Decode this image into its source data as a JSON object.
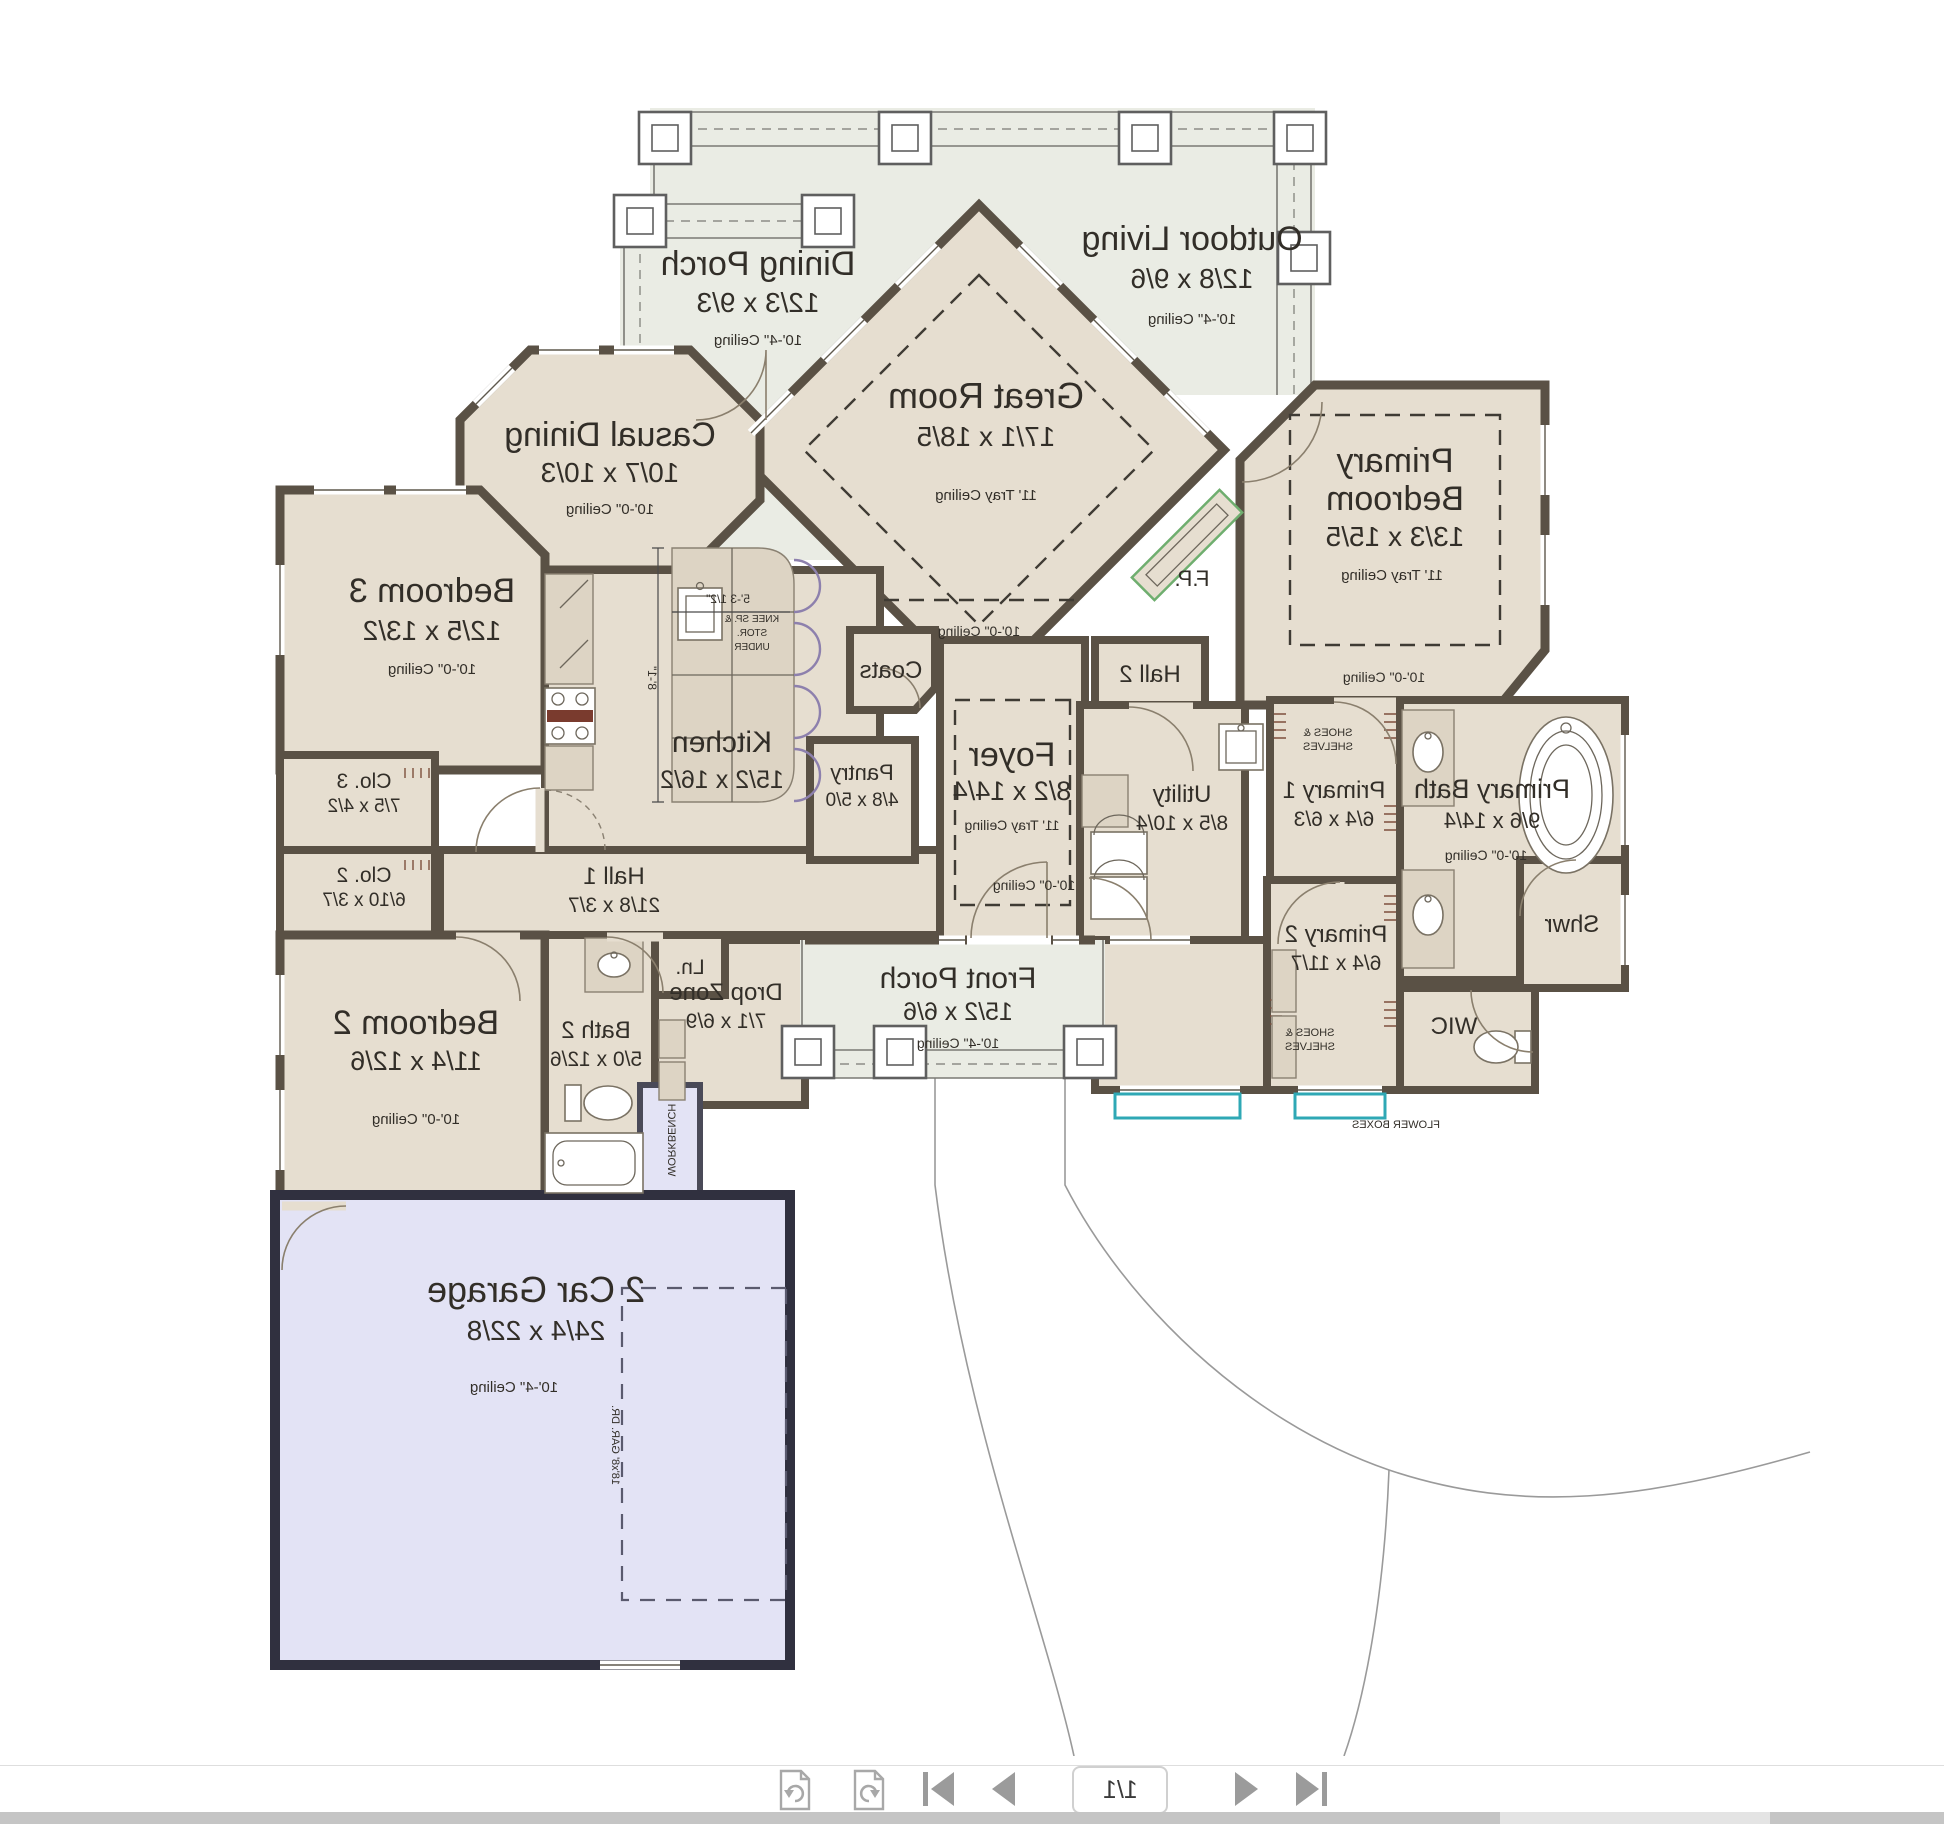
{
  "plan": {
    "rooms": {
      "outdoor_living": {
        "name": "Outdoor Living",
        "dims": "12/8 x 9/6",
        "ceiling": "10'-4\" Ceiling"
      },
      "dining_porch": {
        "name": "Dining Porch",
        "dims": "12/3 x 9/3",
        "ceiling": "10'-4\" Ceiling"
      },
      "great_room": {
        "name": "Great Room",
        "dims": "17/1 x 18/5",
        "ceiling": "11' Tray Ceiling",
        "ceiling2": "10'-0\" Ceiling"
      },
      "casual_dining": {
        "name": "Casual Dining",
        "dims": "10/7 x 10/3",
        "ceiling": "10'-0\" Ceiling"
      },
      "primary_bedroom": {
        "name_line1": "Primary",
        "name_line2": "Bedroom",
        "dims": "13/3 x 15/5",
        "ceiling": "11' Tray Ceiling",
        "ceiling2": "10'-0\" Ceiling"
      },
      "bedroom3": {
        "name": "Bedroom 3",
        "dims": "12/5 x 13/2",
        "ceiling": "10'-0\" Ceiling"
      },
      "kitchen": {
        "name": "Kitchen",
        "dims": "15/2 x 16/2"
      },
      "pantry": {
        "name": "Pantry",
        "dims": "4/8 x 5/0"
      },
      "coats": {
        "name": "Coats"
      },
      "foyer": {
        "name": "Foyer",
        "dims": "8/2 x 14/4",
        "ceiling": "11' Tray Ceiling",
        "ceiling2": "10'-0\" Ceiling"
      },
      "hall2": {
        "name": "Hall 2"
      },
      "utility": {
        "name": "Utility",
        "dims": "8/5 x 10/4"
      },
      "primary1": {
        "name": "Primary 1",
        "dims": "6/4 x 6/3"
      },
      "primary_bath": {
        "name": "Primary Bath",
        "dims": "9/6 x 14/4",
        "ceiling": "10'-0\" Ceiling"
      },
      "shower": {
        "name": "Shwr"
      },
      "primary2": {
        "name": "Primary 2",
        "dims": "6/4 x 11/7"
      },
      "wic": {
        "name": "WIC"
      },
      "closet3": {
        "name": "Clo. 3",
        "dims": "7/5 x 4/2"
      },
      "closet2": {
        "name": "Clo. 2",
        "dims": "6/10 x 3/7"
      },
      "hall1": {
        "name": "Hall 1",
        "dims": "21/8 x 3/7"
      },
      "bedroom2": {
        "name": "Bedroom 2",
        "dims": "11/4 x 12/6",
        "ceiling": "10'-0\" Ceiling"
      },
      "bath2": {
        "name": "Bath 2",
        "dims": "5/0 x 12/6"
      },
      "drop_zone": {
        "name": "Drop Zone",
        "dims": "7/1 x 6/9"
      },
      "linen": {
        "name": "Ln."
      },
      "front_porch": {
        "name": "Front Porch",
        "dims": "15/2 x 6/6",
        "ceiling": "10'-4\" Ceiling"
      },
      "garage": {
        "name": "2 Car Garage",
        "dims": "24/4 x 22/8",
        "ceiling": "10'-4\" Ceiling"
      }
    },
    "annotations": {
      "fireplace": "F.P.",
      "workbench": "WORKBENCH",
      "flower_boxes": "FLOWER BOXES",
      "garage_door": "18'x8' GAR. DR.",
      "shoes_shelves_line1": "SHOES &",
      "shoes_shelves_line2": "SHELVES",
      "knee_line1": "KNEE SP. &",
      "knee_line2": "STOR.",
      "knee_line3": "UNDER",
      "island_width": "5'-3 1/2\"",
      "island_depth": "8'-1\""
    },
    "colors": {
      "wall": "#5a5145",
      "room_fill": "#e6ded0",
      "porch_fill": "#eaece4",
      "garage_fill": "#e3e3f5",
      "flower_box_accent": "#2fa8b5",
      "fireplace_outline": "#6fae6f"
    }
  },
  "toolbar": {
    "page_indicator": "1/1",
    "icons": [
      "undo",
      "redo",
      "first-page",
      "previous-page",
      "next-page",
      "last-page"
    ]
  }
}
